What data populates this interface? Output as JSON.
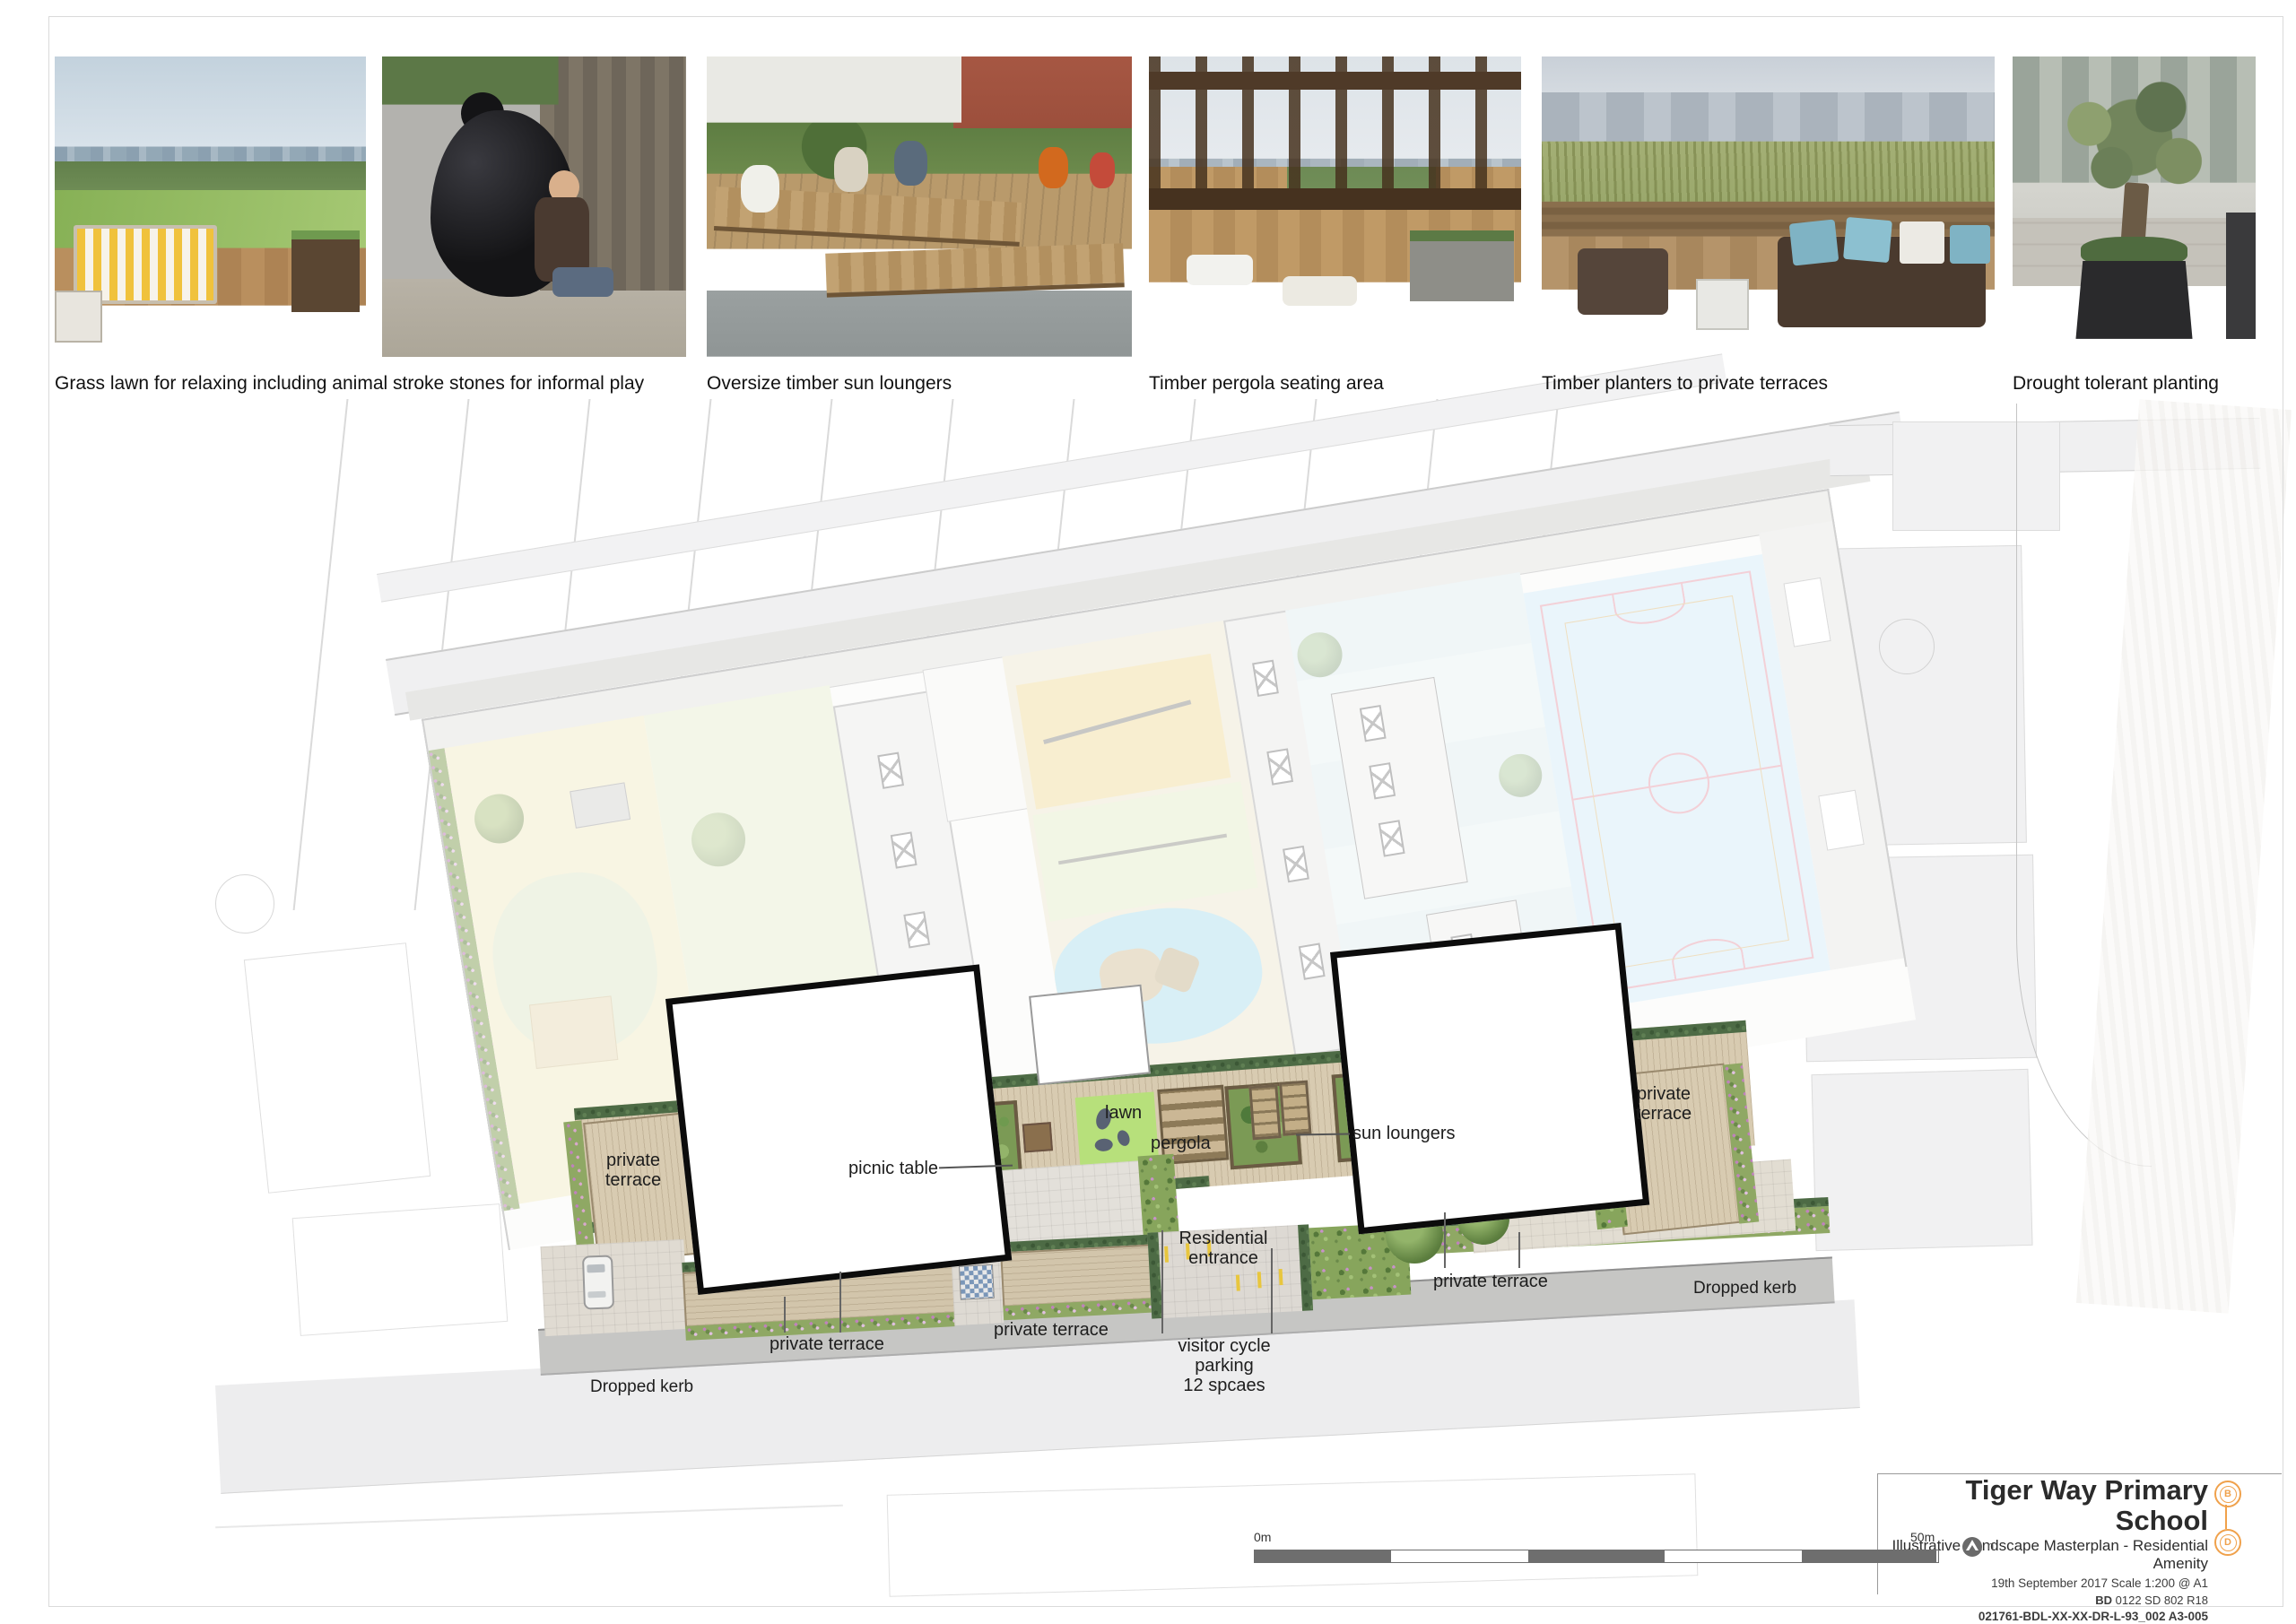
{
  "sheet": {
    "photo_captions": [
      "Grass lawn for relaxing including animal stroke stones for informal play",
      "Oversize timber sun loungers",
      "Timber pergola seating area",
      "Timber planters to private terraces",
      "Drought tolerant planting"
    ],
    "plan_labels": {
      "private_terrace": "private terrace",
      "picnic_table": "picnic table",
      "lawn": "lawn",
      "pergola": "pergola",
      "sun_loungers": "sun loungers",
      "residential_entrance": "Residential entrance",
      "visitor_cycle_parking_line1": "visitor cycle parking",
      "visitor_cycle_parking_line2": "12 spcaes",
      "dropped_kerb": "Dropped kerb"
    },
    "title_block": {
      "project_title": "Tiger Way Primary School",
      "drawing_title": "Illustrative Landscape Masterplan - Residential Amenity",
      "date_and_scale": "19th September 2017  Scale 1:200 @ A1",
      "reference_prefix": "BD",
      "reference_numbers": "0122 SD 802 R18",
      "drawing_number": "021761-BDL-XX-XX-DR-L-93_002  A3-005",
      "revision_marker_top": "B",
      "revision_marker_bottom": "D",
      "marker_color": "#f0a14b"
    },
    "scale_bar": {
      "start_label": "0m",
      "end_label": "50m",
      "segments": 5,
      "bar_color": "#6e6e6e",
      "north_label": "n"
    }
  }
}
